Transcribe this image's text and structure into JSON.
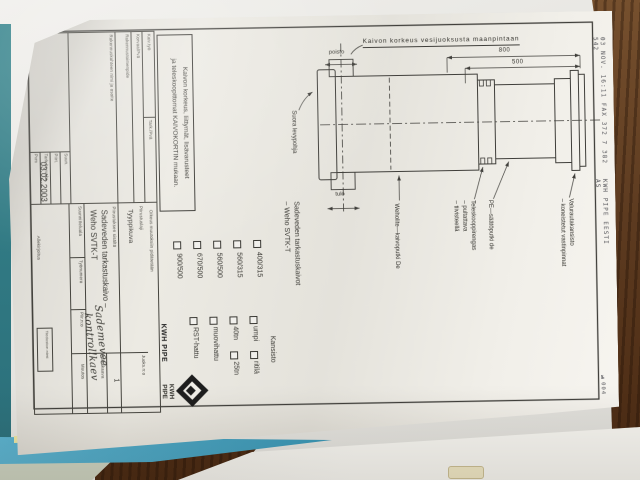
{
  "fax": {
    "line1": "03 NOV. 16:11 FAX 372 7 382 542",
    "line2": "KWH PIPE EESTI AS",
    "page_no": "№004"
  },
  "drawing": {
    "heading": "Kaivon korkeus vesijuoksusta maanpintaan",
    "dim_total": "800",
    "dim_partial": "500",
    "outlet_label": "poisto",
    "inlet_label": "tulo",
    "base_label": "Suora levypohja",
    "callout_pipe": "Weholite—kaivoputki De",
    "callout_telescope_1": "Teleskooppirengas",
    "callout_telescope_2": "– pultattava",
    "callout_telescope_3": "– tiivisteellä",
    "callout_adjust": "PE—säätöputki de",
    "callout_cover_1": "Valurautakansisto",
    "callout_cover_2": "– koneistetut vastinpinnat",
    "note_line1": "Kaivon korkeus, liittymät, lisävarusteet",
    "note_line2": "ja teleskoopittomat KAIVOKORTIN mukaan."
  },
  "selector": {
    "header1": "Sadeveden tarkastuskaivot",
    "header2": "– Weho SVTK-T",
    "sizes": [
      "400/315",
      "560/315",
      "560/500",
      "670/500",
      "900/500"
    ],
    "cover_header": "Kansisto",
    "cover_opts": [
      "umpi",
      "ritilä",
      "40tn",
      "25tn",
      "muovihattu",
      "RST-hattu"
    ]
  },
  "titleblock": {
    "f1": "Kaiv.työ",
    "f2": "Tark./Pvä",
    "f3": "Korvaa/Pvä",
    "f4": "Rakennustoimenpide",
    "f5": "Rakennuskohteen nimi ja osoite",
    "oikeus": "Oikeus muutoksiin pidätetään",
    "brand": "KWH PIPE",
    "logo_text1": "KWH",
    "logo_text2": "PIPE",
    "lab_laji": "Piirustuslaji",
    "val_laji": "Tyyppikuva",
    "lab_sisalto": "Piirustuksen sisältö",
    "val_sisalto1": "Sadeveden tarkastuskaivo –",
    "val_sisalto2": "Weho SVTK-T",
    "lab_juoks": "Juoks.n:o",
    "val_juoks": "1",
    "lab_mitta": "Mittakaava",
    "lab_ala": "Suunnitteluala",
    "lab_tyonro": "Työnumero",
    "lab_piirno": "Piir.n:o",
    "lab_muutos": "Muutos",
    "lab_tiedosto": "Tiedoston nimi",
    "lab_allekirjoitus": "Allekirjoitus",
    "lab_suun": "Suun.",
    "lab_piirt": "Piirt.",
    "lab_tark": "Tark./Hyväks.",
    "lab_pvm": "Pvm",
    "date": "03.02.2003",
    "hand1": "Sademevee",
    "hand2": "kontrollkaev"
  },
  "colors": {
    "paper": "#edebe4",
    "ink": "#3f3e3a",
    "wood": "#5d3b20",
    "folder_blue": "#4aa7c6",
    "folder_teal": "#2f7d86",
    "pen": "#3e4a63"
  }
}
